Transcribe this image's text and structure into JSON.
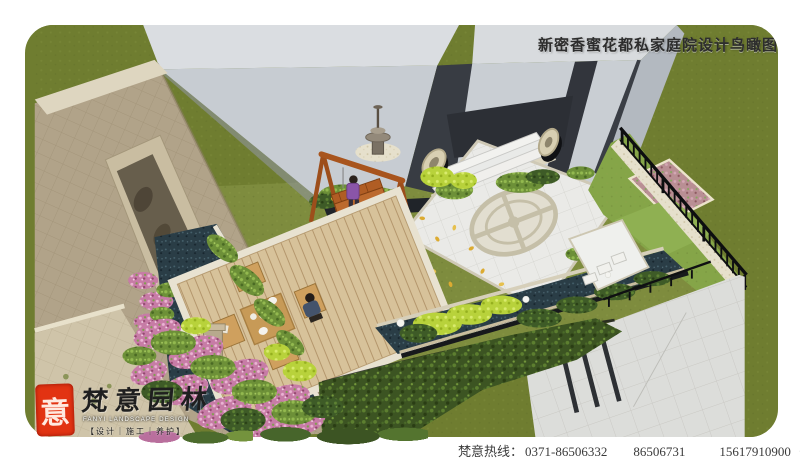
{
  "title": {
    "text": "新密香蜜花都私家庭院设计鸟瞰图"
  },
  "footer": {
    "hotline_label": "梵意热线：",
    "phone1": "0371-86506332",
    "phone2": "86506731",
    "phone3": "15617910900（孙）"
  },
  "logo": {
    "seal_char": "意",
    "brand": "梵意园林",
    "tagline_en": "FANYI LANDSCAPE DESIGN",
    "tagline_cn": "【设计｜施工｜养护】"
  },
  "colors": {
    "seal_red": "#e23312",
    "title_text": "#2d2d2d",
    "footer_text": "#3a3a3a",
    "lawn_outer": "#6f7d30",
    "lawn_inner": "#7e8c3e",
    "building_top": "#d8dbde",
    "building_front": "#c7ccd2",
    "building_dark": "#33363d",
    "stone_wall": "#b1a389",
    "deck_wood": "#d7c29a",
    "pond_water": "#2a3d46",
    "plaza_paving": "#eaeae7",
    "fence_iron": "#0d0e10",
    "flower_pink": "#c77ca6",
    "hedge_green": "#3c5422",
    "pavement_grey": "#dcddda",
    "swing_wood": "#a8541d"
  }
}
